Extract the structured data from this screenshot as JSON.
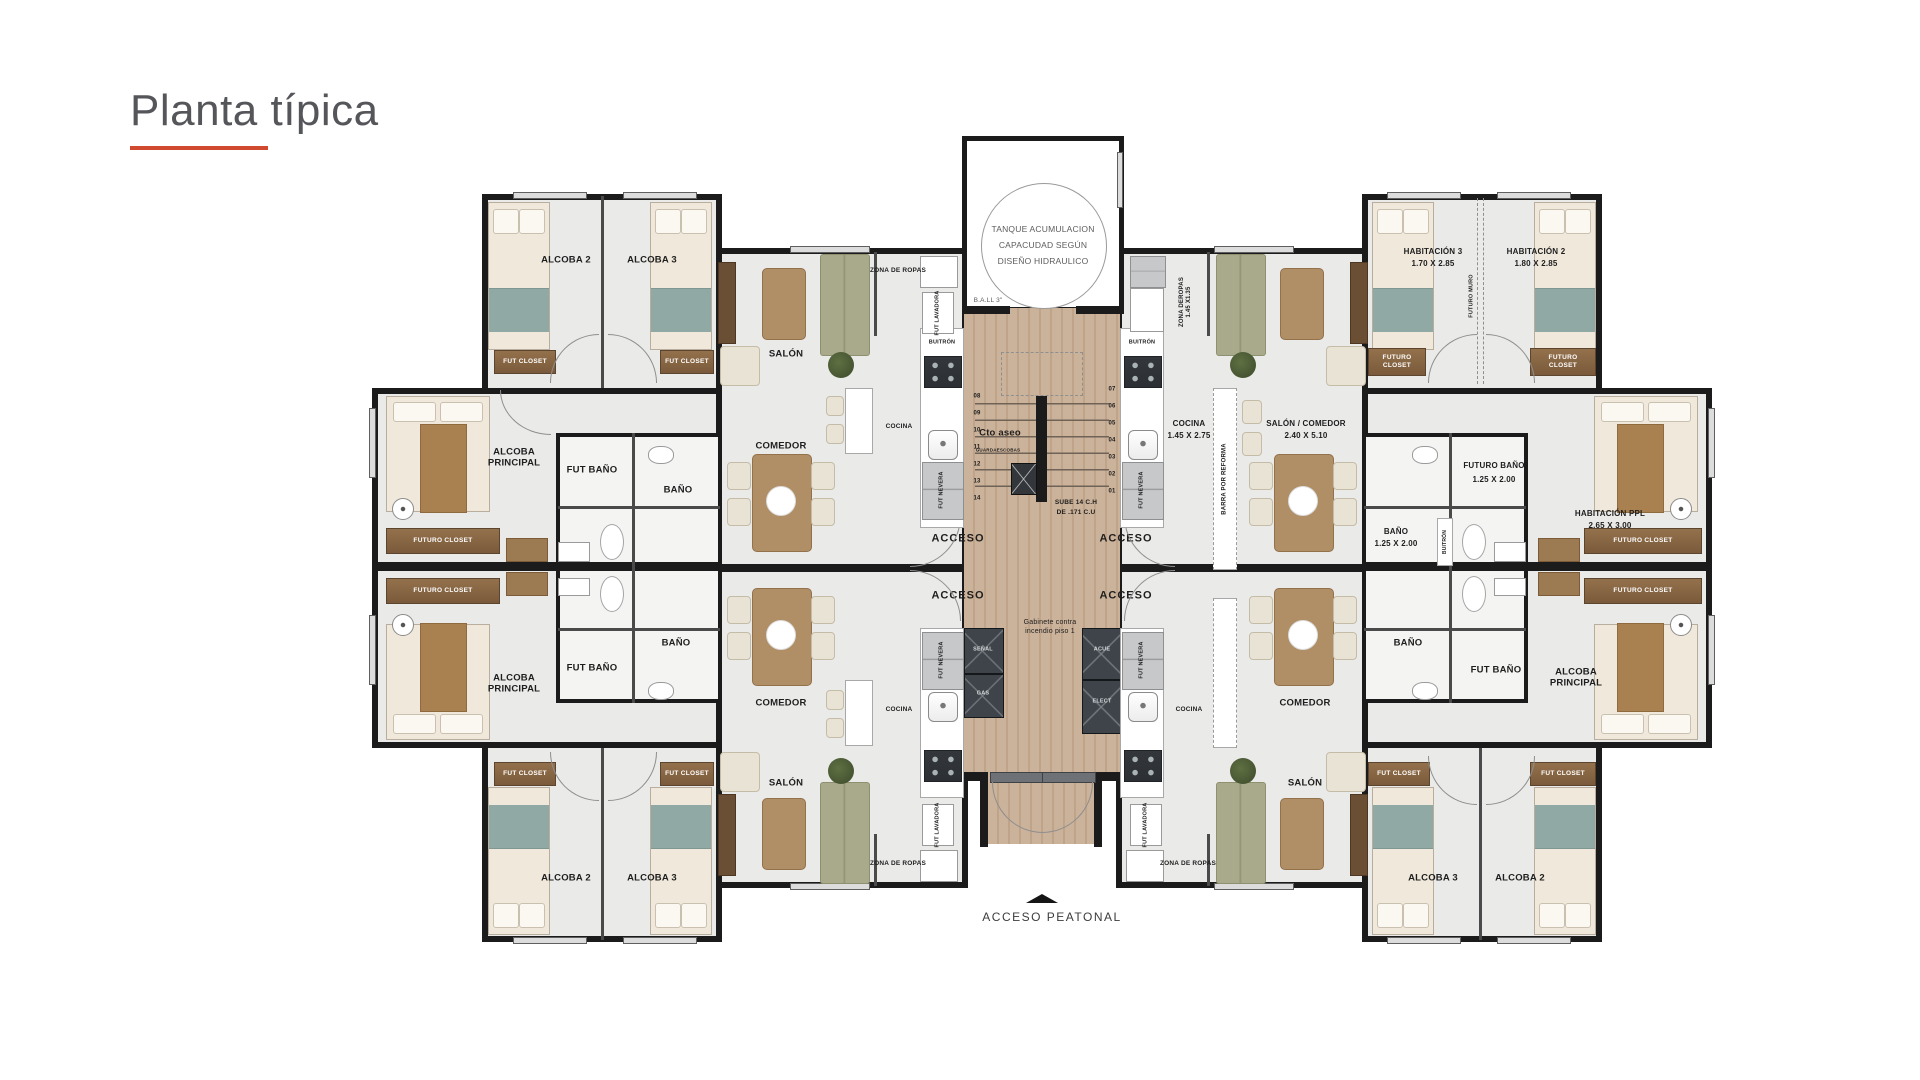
{
  "title": {
    "text": "Planta típica"
  },
  "colors": {
    "accent": "#D04A30",
    "wall": "#1B1B1B",
    "wood": "#CBB29A",
    "teal_blanket": "#90A9A4",
    "olive_sofa": "#A9AA8C",
    "closet_brown": "#8A6A48"
  },
  "s": {
    "alcoba2": "ALCOBA 2",
    "alcoba3": "ALCOBA 3",
    "alcoba_principal": "ALCOBA PRINCIPAL",
    "fut_closet": "FUT CLOSET",
    "futuro_closet": "FUTURO CLOSET",
    "salon": "SALÓN",
    "comedor": "COMEDOR",
    "cocina": "COCINA",
    "zona_de_ropas": "ZONA DE ROPAS",
    "zona_deropas_v": "ZONA DEROPAS",
    "fut_lavadora": "FUT LAVADORA",
    "fut_nevera": "FUT NEVERA",
    "fut_bano": "FUT BAÑO",
    "bano": "BAÑO",
    "futuro_bano": "FUTURO BAÑO",
    "habitacion3": "HABITACIÓN 3",
    "habitacion2": "HABITACIÓN 2",
    "habitacion_ppl": "HABITACIÓN PPL",
    "futuro_muro": "FUTURO MURO",
    "salon_comedor": "SALÓN / COMEDOR",
    "barra_reforma": "BARRA POR REFORMA",
    "acceso": "ACCESO",
    "acceso_peatonal": "ACCESO  PEATONAL",
    "buitron": "BUITRÓN",
    "tank1": "TANQUE ACUMULACION",
    "tank2": "CAPACUDAD SEGÚN",
    "tank3": "DISEÑO HIDRAULICO",
    "ball3": "B.A.LL 3\"",
    "cto_aseo": "Cto aseo",
    "guardaescobas": "GUARDAESCOBAS",
    "sube1": "SUBE 14 C.H",
    "sube2": "DE .171 C.U",
    "gabinete1": "Gabinete contra",
    "gabinete2": "incendio piso 1",
    "senal": "SEÑAL",
    "gas": "GAS",
    "acue": "ACUE",
    "elect": "ELECT"
  },
  "dims": {
    "hab3": "1.70 X 2.85",
    "hab2": "1.80 X 2.85",
    "ppl": "2.65 X 3.00",
    "salon_comedor": "2.40 X 5.10",
    "cocina": "1.45 X 2.75",
    "zona": "1.45 X1.35",
    "bano_fb": "1.25 X 2.00"
  },
  "stairs": {
    "numbers": [
      "01",
      "02",
      "03",
      "04",
      "05",
      "06",
      "07",
      "08",
      "09",
      "10",
      "11",
      "12",
      "13",
      "14"
    ]
  }
}
